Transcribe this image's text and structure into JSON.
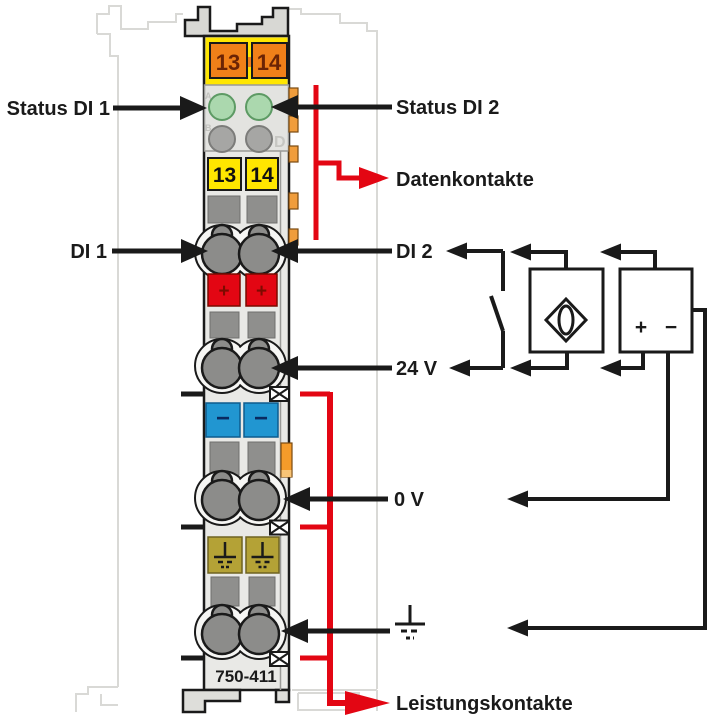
{
  "labels": {
    "status_di1": "Status DI 1",
    "status_di2": "Status DI 2",
    "datenkontakte": "Datenkontakte",
    "di1": "DI 1",
    "di2": "DI 2",
    "v24": "24 V",
    "v0": "0 V",
    "leistungskontakte": "Leistungskontakte"
  },
  "module": {
    "part_number": "750-411",
    "contact_numbers": [
      "13",
      "14"
    ],
    "plus": "+",
    "minus": "−",
    "led_letters": {
      "a": "A",
      "b": "B",
      "d": "D"
    }
  },
  "psu": {
    "plus": "+",
    "minus": "−"
  },
  "colors": {
    "red": "#e30613",
    "orange": "#f08019",
    "yellow": "#ffe600",
    "blue": "#2196d1",
    "olive": "#b4a236",
    "green": "#abd8ae",
    "body": "#e9e9e6"
  }
}
